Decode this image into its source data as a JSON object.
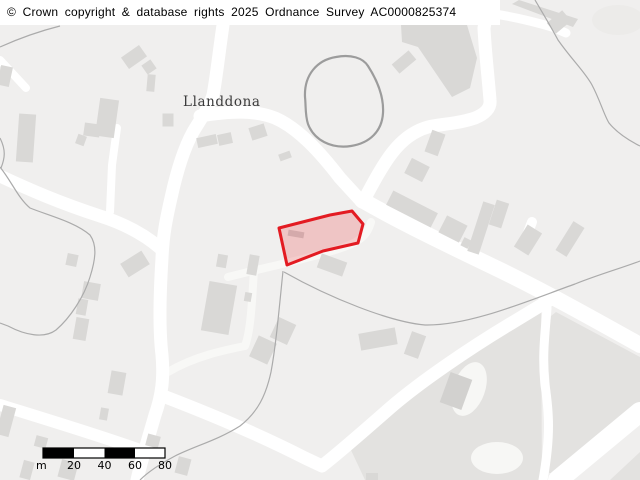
{
  "header": {
    "copyright": "© Crown copyright & database rights 2025 Ordnance Survey AC0000825374"
  },
  "map": {
    "place_label": "Llanddona",
    "colors": {
      "background": "#f0efee",
      "road": "#ffffff",
      "road_minor": "#f8f8f6",
      "building": "#d9d8d6",
      "landuse": "#e3e2e0",
      "boundary_line": "#ababab",
      "loop_outline": "#9c9c9c",
      "parcel_fill": "rgba(237,28,36,0.20)",
      "parcel_stroke": "#e31b22",
      "scale_bar": "#000000"
    },
    "parcel": {
      "points": "279,228 330,215 352,211 363,224 358,243 323,251 287,265"
    }
  },
  "scale_bar": {
    "unit": "m",
    "ticks": [
      "20",
      "40",
      "60",
      "80"
    ]
  }
}
